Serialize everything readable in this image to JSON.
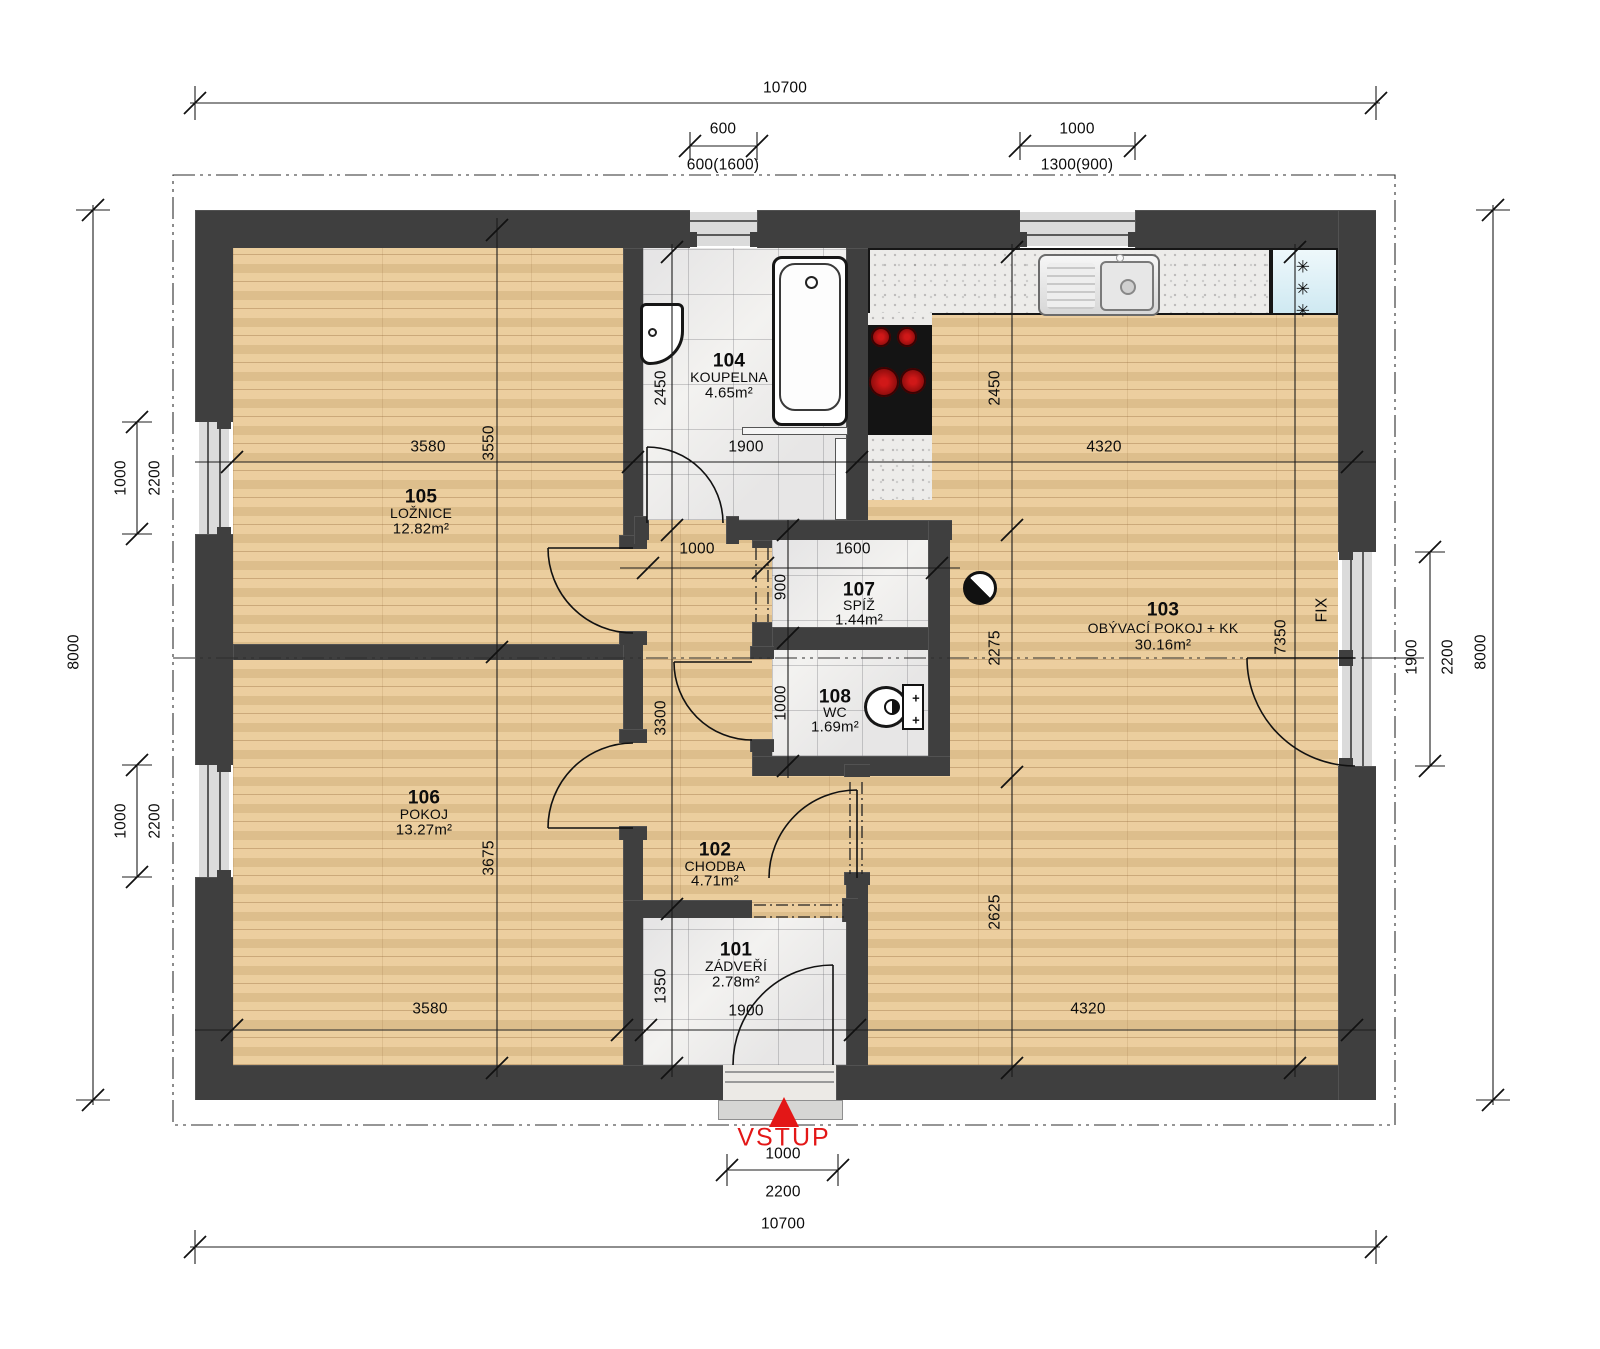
{
  "colors": {
    "wall": "#3f3f3f",
    "wood_floor": "#e9c893",
    "tile_floor": "#f3f2f0",
    "counter": "#edecea",
    "fridge": "#dff0f6",
    "accent_red": "#e31717"
  },
  "rooms": {
    "r101": {
      "number": "101",
      "name": "ZÁDVEŘÍ",
      "area": "2.78m²"
    },
    "r102": {
      "number": "102",
      "name": "CHODBA",
      "area": "4.71m²"
    },
    "r103": {
      "number": "103",
      "name": "OBÝVACÍ POKOJ + KK",
      "area": "30.16m²"
    },
    "r104": {
      "number": "104",
      "name": "KOUPELNA",
      "area": "4.65m²"
    },
    "r105": {
      "number": "105",
      "name": "LOŽNICE",
      "area": "12.82m²"
    },
    "r106": {
      "number": "106",
      "name": "POKOJ",
      "area": "13.27m²"
    },
    "r107": {
      "number": "107",
      "name": "SPÍŽ",
      "area": "1.44m²"
    },
    "r108": {
      "number": "108",
      "name": "WC",
      "area": "1.69m²"
    }
  },
  "dims": {
    "overall_top": "10700",
    "overall_bottom": "10700",
    "overall_left": "8000",
    "overall_right": "8000",
    "top_win1": "600",
    "top_win1_alt": "600(1600)",
    "top_win2": "1000",
    "top_win2_alt": "1300(900)",
    "loznice_w": "3580",
    "loznice_h": "3550",
    "koupelna_w": "1900",
    "koupelna_h": "2450",
    "kk_h": "2450",
    "kk_w": "4320",
    "kk_w_bottom": "4320",
    "living_h": "7350",
    "living_mid": "2275",
    "living_low": "2625",
    "chodba_w": "1000",
    "spiz_w": "1600",
    "spiz_h": "900",
    "wc_h": "1000",
    "chodba_h": "3300",
    "zadveri_h": "1350",
    "zadveri_w": "1900",
    "pokoj_w": "3580",
    "pokoj_h": "3675",
    "left_win_top_w": "1000",
    "left_win_top_total": "2200",
    "left_win_bot_w": "1000",
    "left_win_bot_total": "2200",
    "right_win_w": "1900",
    "right_win_total": "2200",
    "entry_w": "1000",
    "entry_total": "2200"
  },
  "entrance": {
    "label": "VSTUP"
  },
  "symbols": {
    "fix": "FIX",
    "fridge_star": "✳",
    "plus": "+"
  }
}
